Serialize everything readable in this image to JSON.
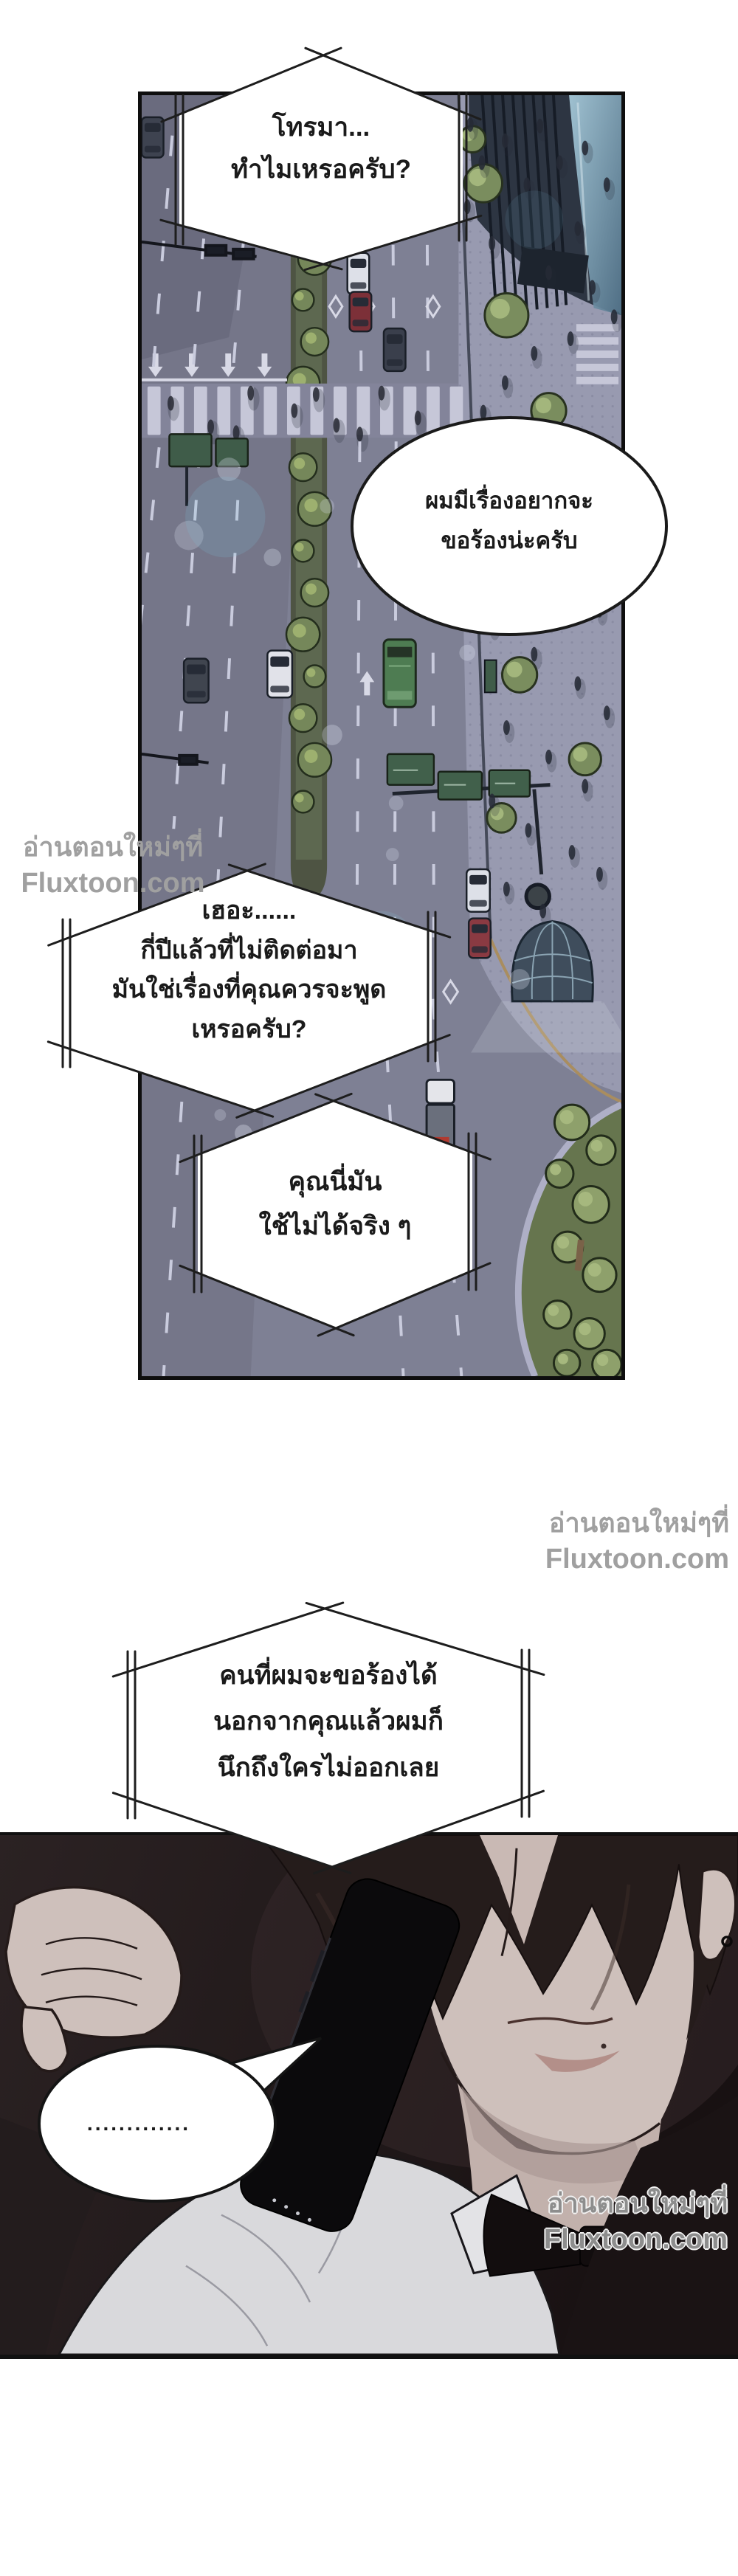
{
  "bubbles": {
    "b1": {
      "style": "hex-phone",
      "lines": [
        "โทรมา...",
        "ทำไมเหรอครับ?"
      ]
    },
    "b2": {
      "style": "oval",
      "lines": [
        "ผมมีเรื่องอยากจะ",
        "ขอร้องน่ะครับ"
      ]
    },
    "b3": {
      "style": "hex-phone",
      "lines": [
        "เฮอะ......",
        "กี่ปีแล้วที่ไม่ติดต่อมา",
        "มันใช่เรื่องที่คุณควรจะพูด",
        "เหรอครับ?"
      ]
    },
    "b4": {
      "style": "hex-phone",
      "lines": [
        "คุณนี่มัน",
        "ใช้ไม่ได้จริง ๆ"
      ]
    },
    "b5": {
      "style": "hex-phone",
      "lines": [
        "คนที่ผมจะขอร้องได้",
        "นอกจากคุณแล้วผมก็",
        "นึกถึงใครไม่ออกเลย"
      ]
    },
    "b6": {
      "style": "oval",
      "lines": [
        "............."
      ]
    }
  },
  "watermarks": {
    "site_line1": "อ่านตอนใหม่ๆที่",
    "site_line2": "Fluxtoon.com"
  },
  "palette": {
    "page_bg": "#ffffff",
    "panel_border": "#0e0e0e",
    "road": "#7e8094",
    "plaza": "#989ab0",
    "median_green": "#5d6850",
    "tree_green": "#7a8d5e",
    "building_dark": "#2d3542",
    "glass_blue": "#6e93a6",
    "night_dark": "#1d1617",
    "skin": "#cec0bb",
    "hair": "#251c1b",
    "shirt": "#d9d9dc",
    "bowtie_black": "#120d0e",
    "phone_black": "#0b0a0c",
    "bubble_fill": "#ffffff",
    "bubble_stroke": "#1d1d1d",
    "watermark_gray": "#a0a0a0"
  }
}
